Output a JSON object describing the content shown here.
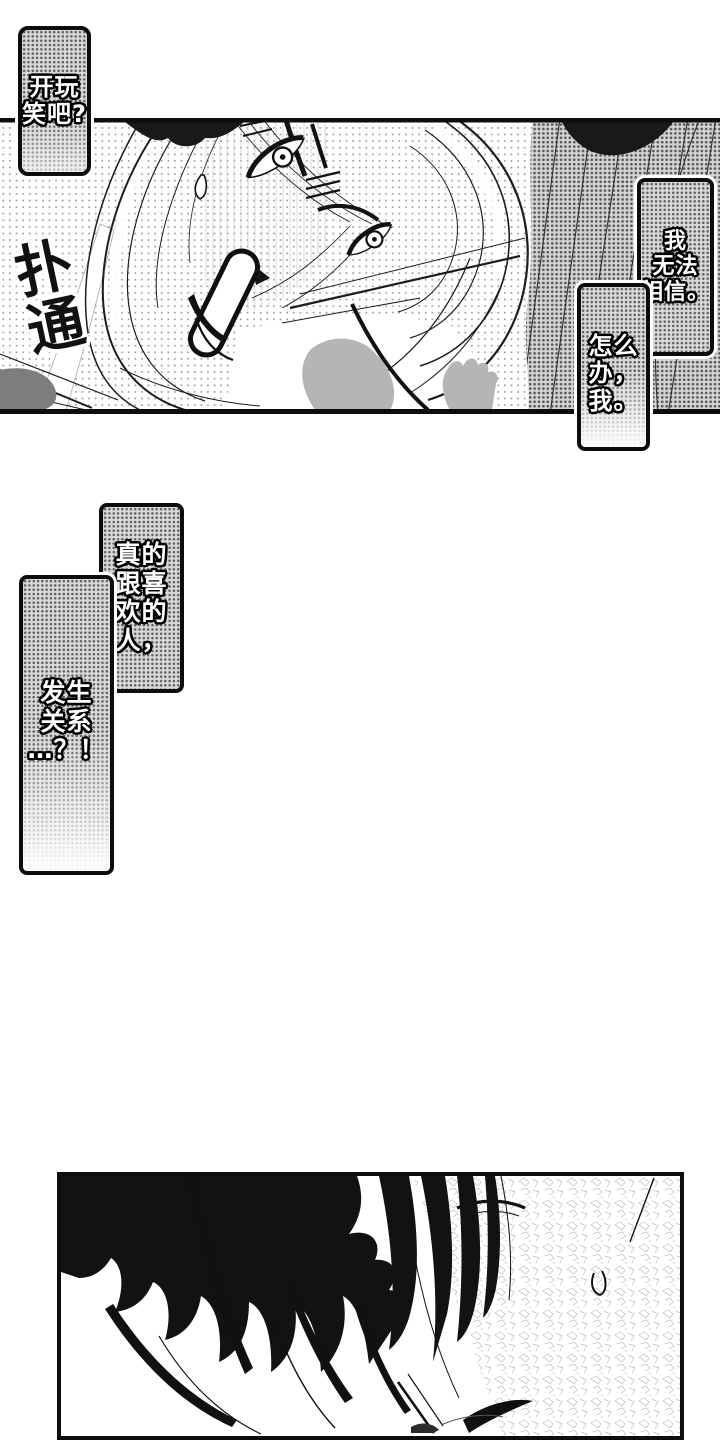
{
  "colors": {
    "ink": "#111111",
    "paper": "#ffffff",
    "bubble_halftone": "#d9d9d9",
    "bubble_text": "#ffffff",
    "sfx_text": "#111111"
  },
  "bubbles": {
    "kidding": {
      "lines": [
        "开玩",
        "笑吧?"
      ]
    },
    "cant_believe": {
      "lines": [
        "我",
        "无法",
        "相信。"
      ]
    },
    "what_do": {
      "lines": [
        "怎么",
        "办，",
        "我。"
      ]
    },
    "really_upper": {
      "lines": [
        "真的",
        "跟喜",
        "欢的",
        "人，"
      ]
    },
    "really_lower": {
      "lines": [
        "发生",
        "关系",
        "…？！"
      ]
    }
  },
  "sfx": {
    "putong": {
      "lines": [
        "扑",
        "通"
      ]
    }
  }
}
